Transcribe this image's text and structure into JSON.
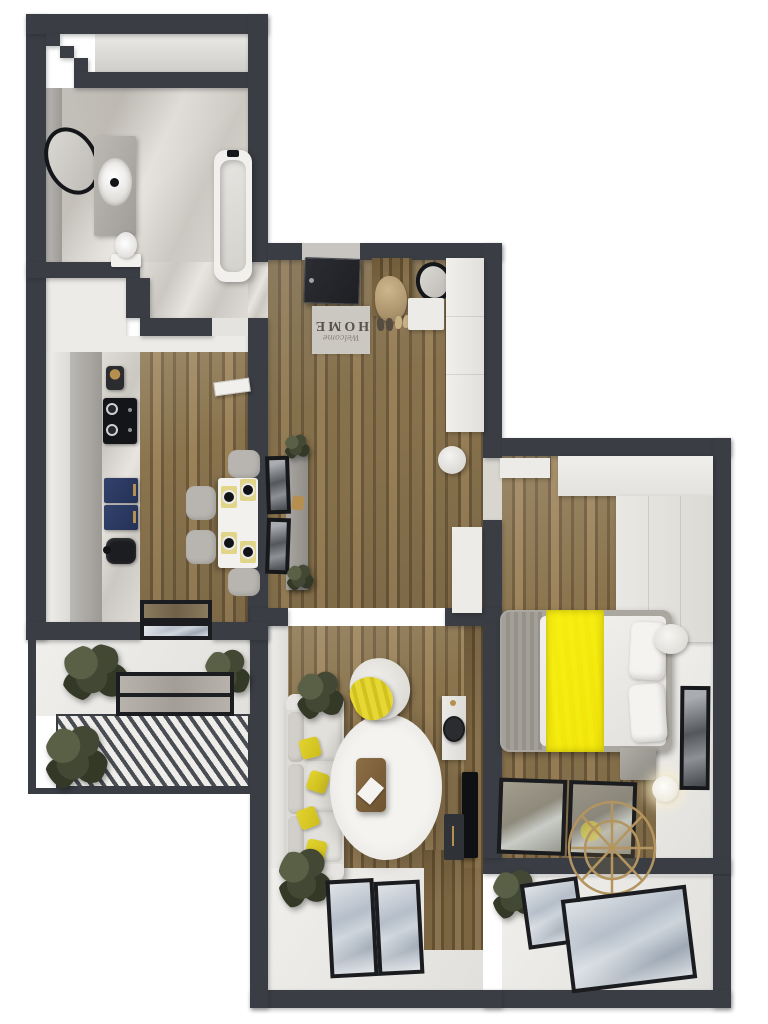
{
  "image_type": "3d-apartment-floor-plan-top-view",
  "doormat": {
    "line1": "Welcome",
    "line2": "HOME"
  },
  "colors": {
    "wall": "#3a3e44",
    "frame": "#1a1c1f",
    "woodA": "#8a744e",
    "woodB": "#6e593a",
    "woodC": "#9b8259",
    "marbleA": "#dfdcd7",
    "marbleB": "#cbc7c1",
    "skyA": "#b5bec9",
    "skyB": "#9fa9b5",
    "skyC": "#dfe3e7",
    "plantA": "#5a6046",
    "plantB": "#434834",
    "plantC": "#343927",
    "yellow": "#e2d32f",
    "yellowPale": "#e0d588",
    "navy": "#2e3f66",
    "gold": "#b58f4f",
    "matBg": "#cbc8c2",
    "matText": "#56524a"
  },
  "rooms": [
    {
      "name": "bathroom",
      "items": [
        "bathtub",
        "vanity-sink",
        "oval-mirror",
        "toilet",
        "marble-floor"
      ]
    },
    {
      "name": "kitchen",
      "items": [
        "coffee-maker",
        "cooktop",
        "navy-cabinets",
        "sink",
        "dining-table",
        "chairs",
        "place-settings",
        "balcony-glass-door"
      ]
    },
    {
      "name": "entry-hall",
      "items": [
        "front-door",
        "welcome-mat",
        "coat-rack",
        "shoes",
        "oval-mirror",
        "built-in-wardrobe",
        "console-with-picture-frames",
        "pouf"
      ]
    },
    {
      "name": "living-room",
      "items": [
        "sofa",
        "yellow-pillows",
        "bean-bag",
        "fur-rug",
        "coffee-table",
        "desk",
        "desk-chair",
        "tv",
        "media-console",
        "plants",
        "window"
      ]
    },
    {
      "name": "bedroom",
      "items": [
        "double-bed",
        "yellow-runner",
        "pillows",
        "wardrobe",
        "shelf",
        "nightstands",
        "floor-lamp",
        "wall-art",
        "hanging-chair",
        "windows"
      ]
    },
    {
      "name": "kitchen-balcony",
      "items": [
        "plants",
        "slatted-deck",
        "glass-door-frames"
      ]
    },
    {
      "name": "bedroom-balcony",
      "items": [
        "plant",
        "windows"
      ]
    }
  ]
}
